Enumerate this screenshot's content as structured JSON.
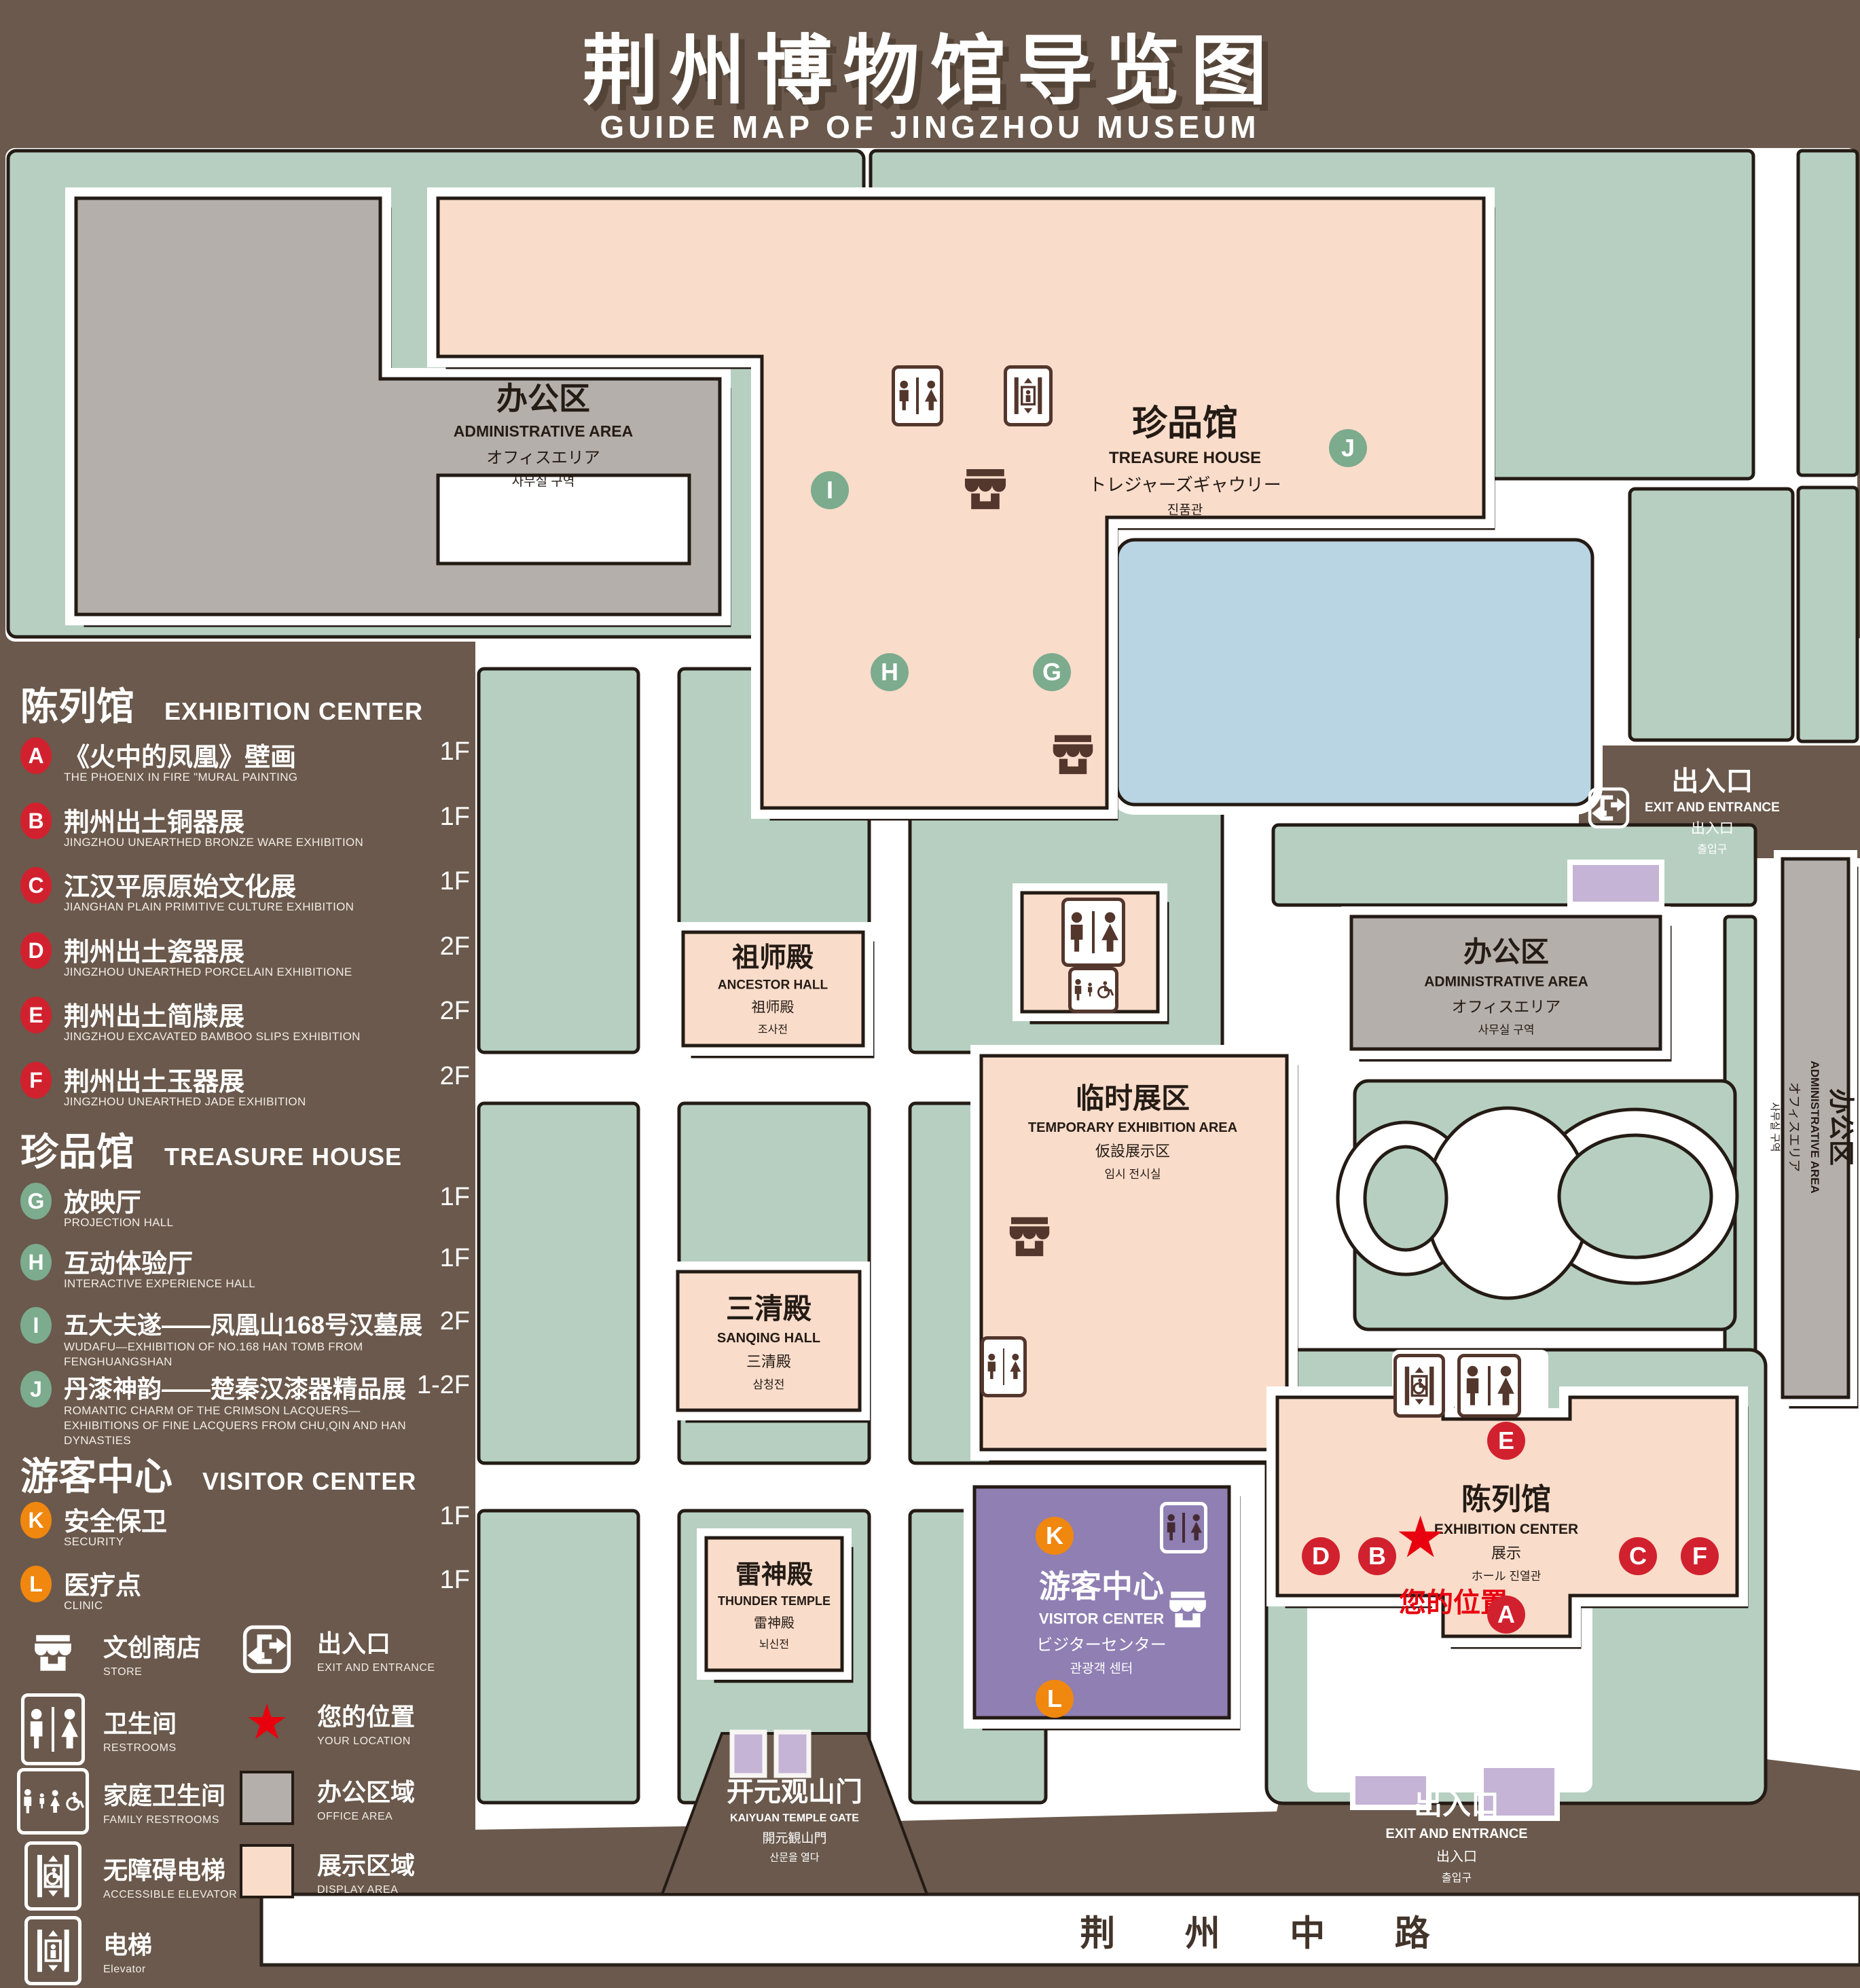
{
  "title": {
    "zh": "荆州博物馆导览图",
    "en": "GUIDE MAP OF JINGZHOU MUSEUM"
  },
  "colors": {
    "background": "#6a594c",
    "landscape_green": "#b6cfc1",
    "display_area": "#f9dcca",
    "office_area": "#b5afab",
    "water": "#b9d4e2",
    "visitor_purple": "#8f7fb3",
    "light_purple": "#c5b4d6",
    "badge_red": "#d2212e",
    "badge_green": "#7cab8e",
    "badge_orange": "#f0870f",
    "icon_brown": "#53362c",
    "location_red": "#e8000e"
  },
  "sidebar": {
    "sections": [
      {
        "zh": "陈列馆",
        "en": "EXHIBITION CENTER",
        "items": [
          {
            "id": "A",
            "zh": "《火中的凤凰》壁画",
            "en": "THE PHOENIX IN FIRE \"MURAL PAINTING",
            "floor": "1F"
          },
          {
            "id": "B",
            "zh": "荆州出土铜器展",
            "en": "JINGZHOU UNEARTHED BRONZE WARE EXHIBITION",
            "floor": "1F"
          },
          {
            "id": "C",
            "zh": "江汉平原原始文化展",
            "en": "JIANGHAN PLAIN PRIMITIVE CULTURE EXHIBITION",
            "floor": "1F"
          },
          {
            "id": "D",
            "zh": "荆州出土瓷器展",
            "en": "JINGZHOU UNEARTHED PORCELAIN EXHIBITIONE",
            "floor": "2F"
          },
          {
            "id": "E",
            "zh": "荆州出土简牍展",
            "en": "JINGZHOU EXCAVATED BAMBOO SLIPS EXHIBITION",
            "floor": "2F"
          },
          {
            "id": "F",
            "zh": "荆州出土玉器展",
            "en": "JINGZHOU UNEARTHED JADE EXHIBITION",
            "floor": "2F"
          }
        ]
      },
      {
        "zh": "珍品馆",
        "en": "TREASURE HOUSE",
        "items": [
          {
            "id": "G",
            "zh": "放映厅",
            "en": "PROJECTION HALL",
            "floor": "1F"
          },
          {
            "id": "H",
            "zh": "互动体验厅",
            "en": "INTERACTIVE EXPERIENCE HALL",
            "floor": "1F"
          },
          {
            "id": "I",
            "zh": "五大夫遂——凤凰山168号汉墓展",
            "en": "WUDAFU—EXHIBITION OF NO.168 HAN TOMB FROM FENGHUANGSHAN",
            "floor": "2F"
          },
          {
            "id": "J",
            "zh": "丹漆神韵——楚秦汉漆器精品展",
            "en": "ROMANTIC CHARM OF THE CRIMSON LACQUERS—EXHIBITIONS OF FINE LACQUERS FROM CHU,QIN AND HAN DYNASTIES",
            "floor": "1-2F"
          }
        ]
      },
      {
        "zh": "游客中心",
        "en": "VISITOR CENTER",
        "items": [
          {
            "id": "K",
            "zh": "安全保卫",
            "en": "SECURITY",
            "floor": "1F"
          },
          {
            "id": "L",
            "zh": "医疗点",
            "en": "CLINIC",
            "floor": "1F"
          }
        ]
      }
    ],
    "legend": [
      {
        "icon": "store-icon",
        "zh": "文创商店",
        "en": "STORE"
      },
      {
        "icon": "exit-icon",
        "zh": "出入口",
        "en": "EXIT AND ENTRANCE"
      },
      {
        "icon": "restrooms-icon",
        "zh": "卫生间",
        "en": "RESTROOMS"
      },
      {
        "icon": "your-location-star-icon",
        "zh": "您的位置",
        "en": "YOUR LOCATION"
      },
      {
        "icon": "family-restrooms-icon",
        "zh": "家庭卫生间",
        "en": "FAMILY RESTROOMS"
      },
      {
        "icon": "office-area-swatch",
        "zh": "办公区域",
        "en": "OFFICE AREA"
      },
      {
        "icon": "accessible-elevator-icon",
        "zh": "无障碍电梯",
        "en": "ACCESSIBLE ELEVATOR"
      },
      {
        "icon": "display-area-swatch",
        "zh": "展示区域",
        "en": "DISPLAY AREA"
      },
      {
        "icon": "elevator-icon",
        "zh": "电梯",
        "en": "Elevator"
      }
    ]
  },
  "map": {
    "buildings": {
      "admin": {
        "zh": "办公区",
        "en": "ADMINISTRATIVE AREA",
        "jp": "オフィスエリア",
        "kr": "사무실 구역"
      },
      "treasure": {
        "zh": "珍品馆",
        "en": "TREASURE HOUSE",
        "jp": "トレジャーズギャウリー",
        "kr": "진품관"
      },
      "ancestor": {
        "zh": "祖师殿",
        "en": "ANCESTOR HALL",
        "jp": "祖师殿",
        "kr": "조사전"
      },
      "temporary": {
        "zh": "临时展区",
        "en": "TEMPORARY EXHIBITION AREA",
        "jp": "仮設展示区",
        "kr": "임시 전시실"
      },
      "sanqing": {
        "zh": "三清殿",
        "en": "SANQING HALL",
        "jp": "三清殿",
        "kr": "삼청전"
      },
      "thunder": {
        "zh": "雷神殿",
        "en": "THUNDER TEMPLE",
        "jp": "雷神殿",
        "kr": "뇌신전"
      },
      "visitor": {
        "zh": "游客中心",
        "en": "VISITOR CENTER",
        "jp": "ビジターセンター",
        "kr": "관광객 센터"
      },
      "exhibition": {
        "zh": "陈列馆",
        "en": "EXHIBITION CENTER",
        "jp": "展示",
        "kr": "ホール 진열관"
      },
      "gate": {
        "zh": "开元观山门",
        "en": "KAIYUAN TEMPLE GATE",
        "jp": "開元観山門",
        "kr": "산문을 열다"
      }
    },
    "exit": {
      "zh": "出入口",
      "en": "EXIT AND ENTRANCE",
      "jp": "出入口",
      "kr": "출입구"
    },
    "road": "荆 州 中 路",
    "your_location": "您的位置",
    "markers": {
      "A": "A",
      "B": "B",
      "C": "C",
      "D": "D",
      "E": "E",
      "F": "F",
      "G": "G",
      "H": "H",
      "I": "I",
      "J": "J",
      "K": "K",
      "L": "L"
    }
  }
}
